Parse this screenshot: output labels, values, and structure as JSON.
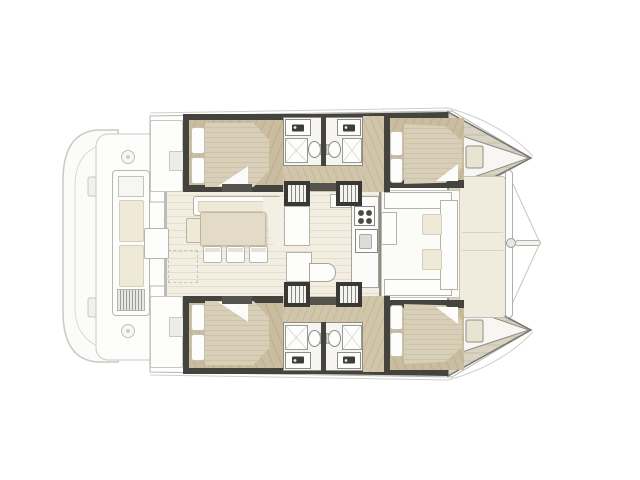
{
  "diagram": {
    "type": "catamaran-floor-plan",
    "orientation": "bow-right",
    "hull_count": 2,
    "regions": [
      "aft-platform",
      "aft-cockpit",
      "saloon-dinette",
      "galley",
      "hull-aft-cabin",
      "hull-aft-head",
      "hull-forward-head",
      "hull-forward-cabin",
      "companionway-stairs",
      "forward-cockpit",
      "foredeck",
      "crossbeam",
      "bowsprit"
    ],
    "fixtures": [
      "double-berth",
      "pillows",
      "sink-vanity",
      "toilet",
      "shower",
      "dining-table",
      "chairs",
      "sofa",
      "stove",
      "galley-sink",
      "cockpit-bench",
      "cockpit-table",
      "sun-pads",
      "bow-hatch"
    ]
  },
  "colors": {
    "background": "#ffffff",
    "outline": "#c6c6c2",
    "outline_dark": "#45433e",
    "dark_bar": "#55534d",
    "wood": "#c9bc9f",
    "wood_stripe": "#bcae90",
    "wood_light": "#d2c6aa",
    "wood_light_stripe": "#c5b79b",
    "mattress": "#d8cfb8",
    "mattress_stripe": "#cdc3aa",
    "saloon_floor": "#f3eee2",
    "saloon_plank": "#e6decd",
    "cushion": "#efe9d7",
    "cushion_border": "#d5cebb",
    "panel": "#f0ebdd",
    "fixture": "#fdfdfc",
    "table": "#e3dbc6",
    "steel": "#8e8c85",
    "bow_stripe_a": "#d9d3c3",
    "bow_stripe_b": "#cfc8b7"
  }
}
